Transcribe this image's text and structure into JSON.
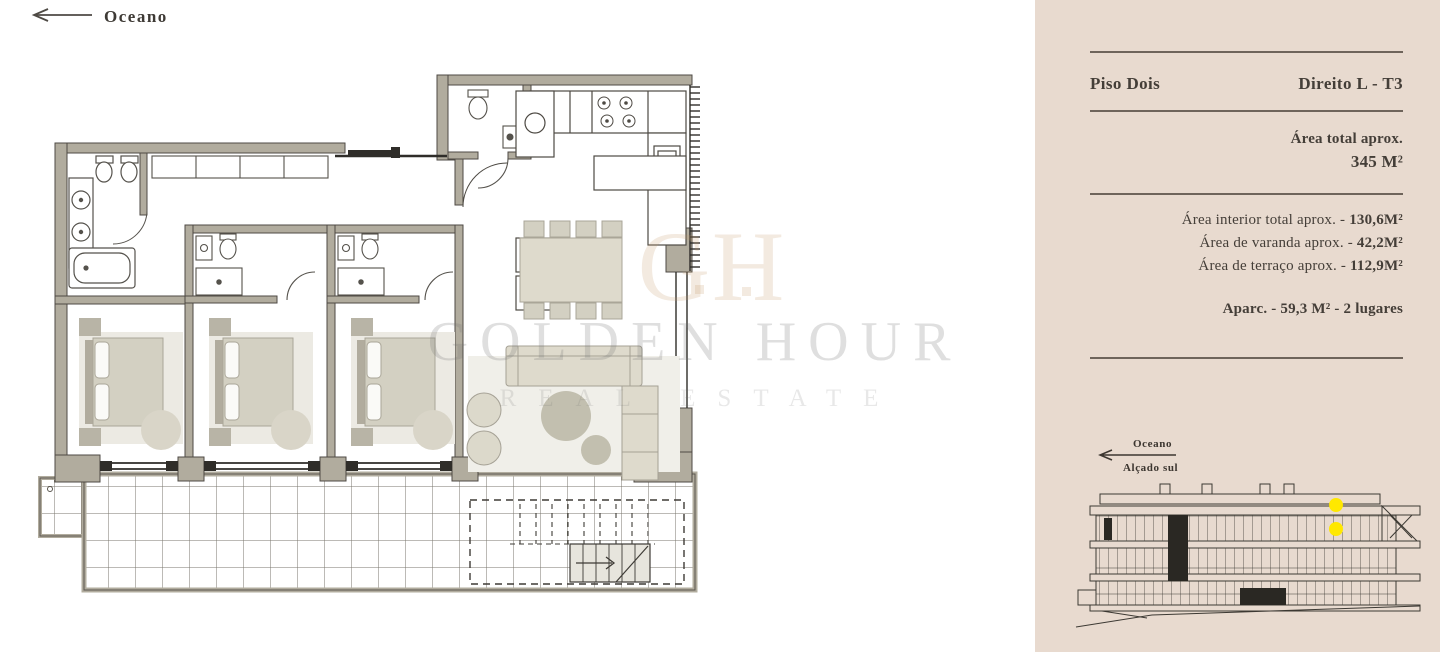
{
  "plan": {
    "orientation_label": "Oceano",
    "watermark": {
      "monogram": "GH",
      "line1": "GOLDEN HOUR",
      "line2": "REAL ESTATE"
    }
  },
  "ui": {
    "dash": " - "
  },
  "sidebar": {
    "floor_label": "Piso Dois",
    "unit_label": "Direito L - T3",
    "total": {
      "label": "Área total aprox.",
      "value": "345 M²"
    },
    "areas": [
      {
        "label": "Área interior total aprox.",
        "value": "130,6M²"
      },
      {
        "label": "Área de varanda aprox.",
        "value": "42,2M²"
      },
      {
        "label": "Área de terraço aprox.",
        "value": "112,9M²"
      }
    ],
    "parking": {
      "label": "Aparc.",
      "value": "59,3 M²",
      "extra": "2 lugares"
    },
    "elevation": {
      "direction_label": "Oceano",
      "caption": "Alçado sul"
    }
  },
  "colors": {
    "sidebar_bg": "#e8dacf",
    "accent_highlight": "#ffe800",
    "wall": "#b1ac9e",
    "text": "#443e38",
    "watermark_gray": "#dcdcdc"
  }
}
